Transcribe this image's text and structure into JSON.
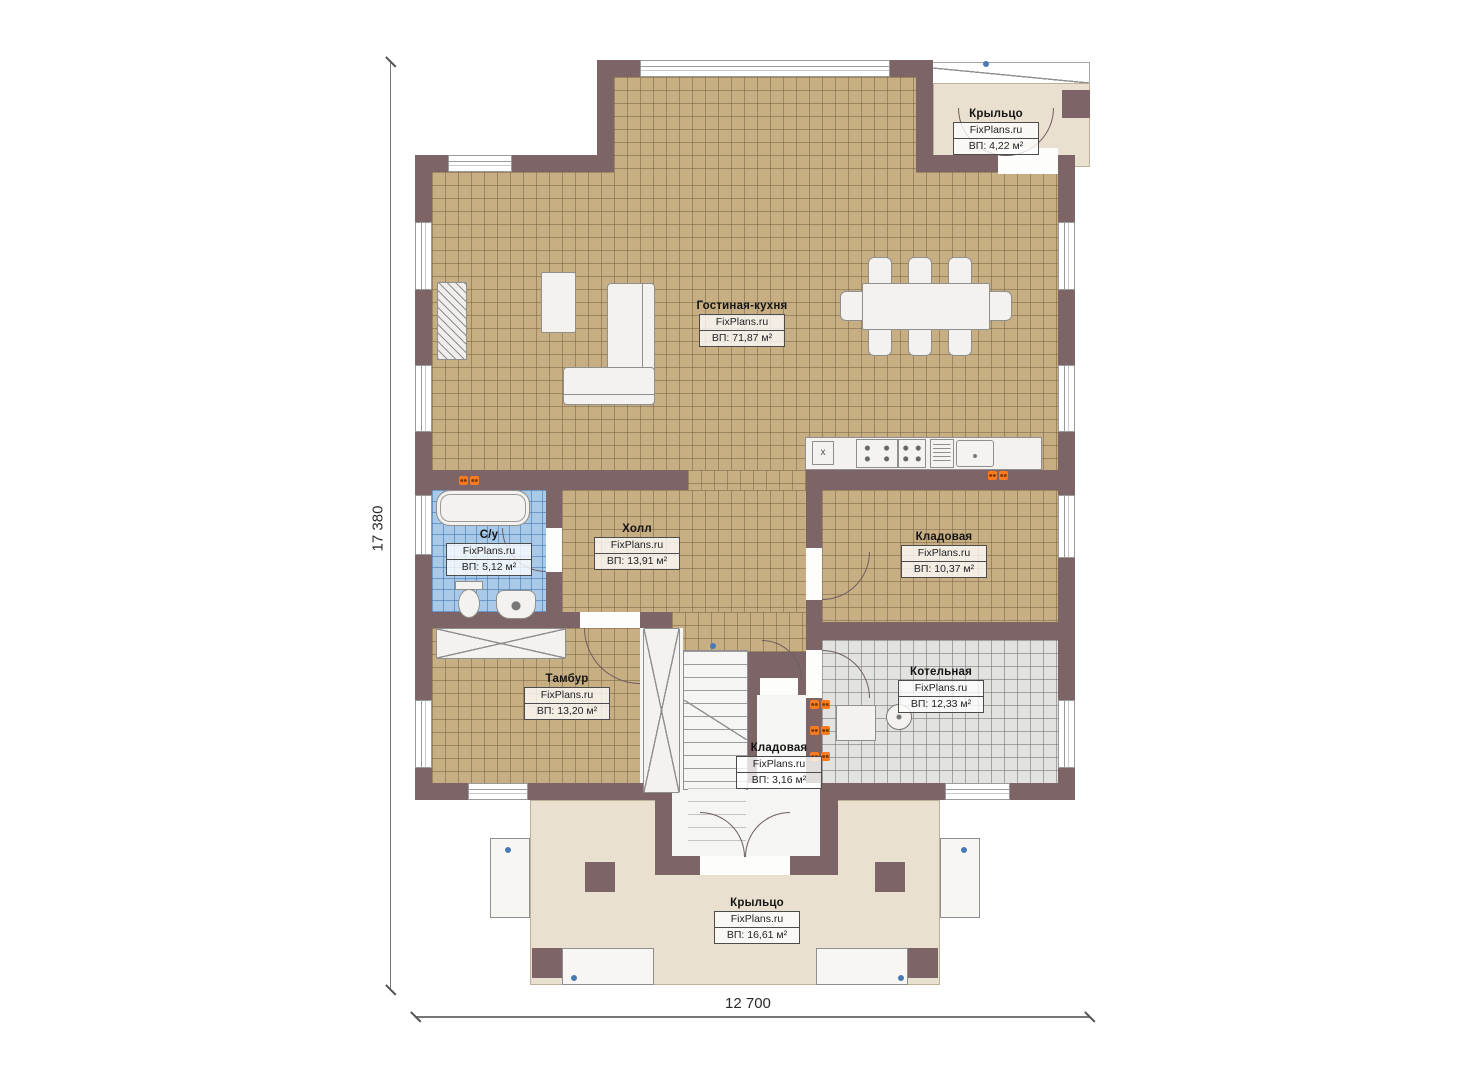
{
  "watermark": "FixPlans.ru",
  "dimensions": {
    "height_label": "17 380",
    "width_label": "12 700"
  },
  "marks": {
    "counter_sink": "x"
  },
  "colors": {
    "wall": "#7d6467",
    "tile_floor": "#c8af83",
    "porch_floor": "#e9e0cf",
    "wc_floor": "#a9c9e9",
    "boiler_floor": "#e2e2e1",
    "outlet": "#ff7a1e",
    "marker_blue": "#4a7ab5"
  },
  "rooms": [
    {
      "name": "Гостиная-кухня",
      "area": "ВП: 71,87 м²"
    },
    {
      "name": "Крыльцо",
      "area": "ВП: 4,22 м²"
    },
    {
      "name": "Холл",
      "area": "ВП: 13,91 м²"
    },
    {
      "name": "Кладовая",
      "area": "ВП: 10,37 м²"
    },
    {
      "name": "С/у",
      "area": "ВП: 5,12 м²"
    },
    {
      "name": "Тамбур",
      "area": "ВП: 13,20 м²"
    },
    {
      "name": "Котельная",
      "area": "ВП: 12,33 м²"
    },
    {
      "name": "Кладовая",
      "area": "ВП: 3,16 м²"
    },
    {
      "name": "Крыльцо",
      "area": "ВП: 16,61 м²"
    }
  ]
}
